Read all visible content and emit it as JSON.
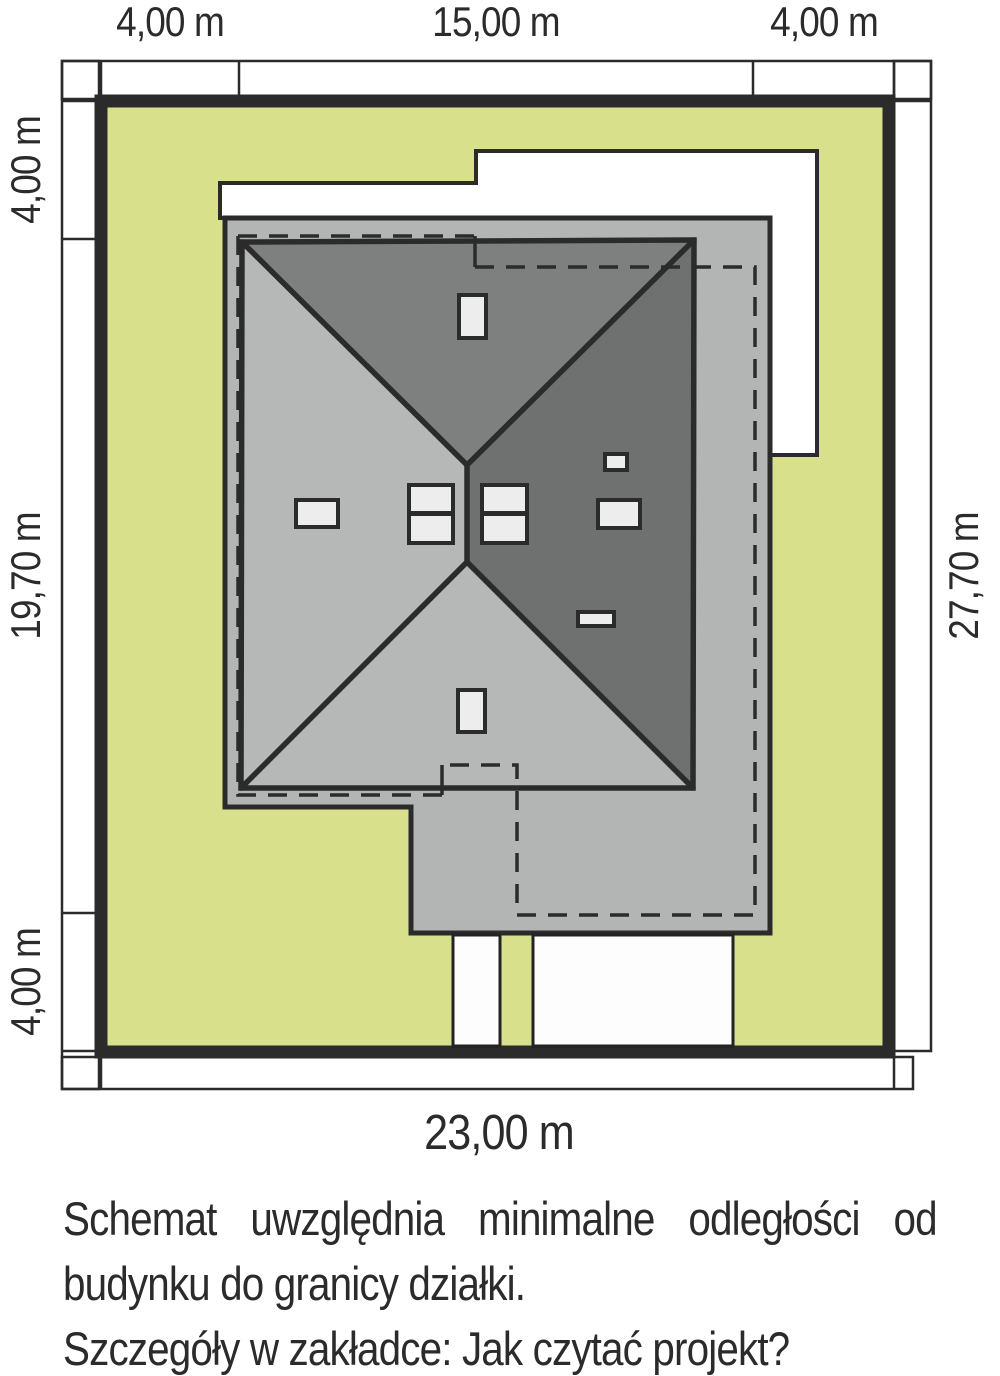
{
  "plan": {
    "title": "site-plan-schematic",
    "dimensions": {
      "top": [
        "4,00 m",
        "15,00 m",
        "4,00 m"
      ],
      "left": [
        "4,00 m",
        "19,70 m",
        "4,00 m"
      ],
      "right": "27,70 m",
      "bottom": "23,00 m"
    },
    "notes": {
      "line1": "Schemat uwzględnia minimalne odległości od",
      "line2": "budynku do granicy działki.",
      "line3": "Szczegóły w zakładce: Jak czytać projekt?"
    },
    "colors": {
      "plot_green": "#d9e08c",
      "slab_gray": "#b3b5b5",
      "roof_face_light": "#b6b8b8",
      "roof_face_top": "#7e8080",
      "roof_face_right": "#6f7171",
      "roof_fixture_white": "#ededed",
      "line_dark": "#2b2b2b",
      "paper_white": "#ffffff"
    }
  }
}
